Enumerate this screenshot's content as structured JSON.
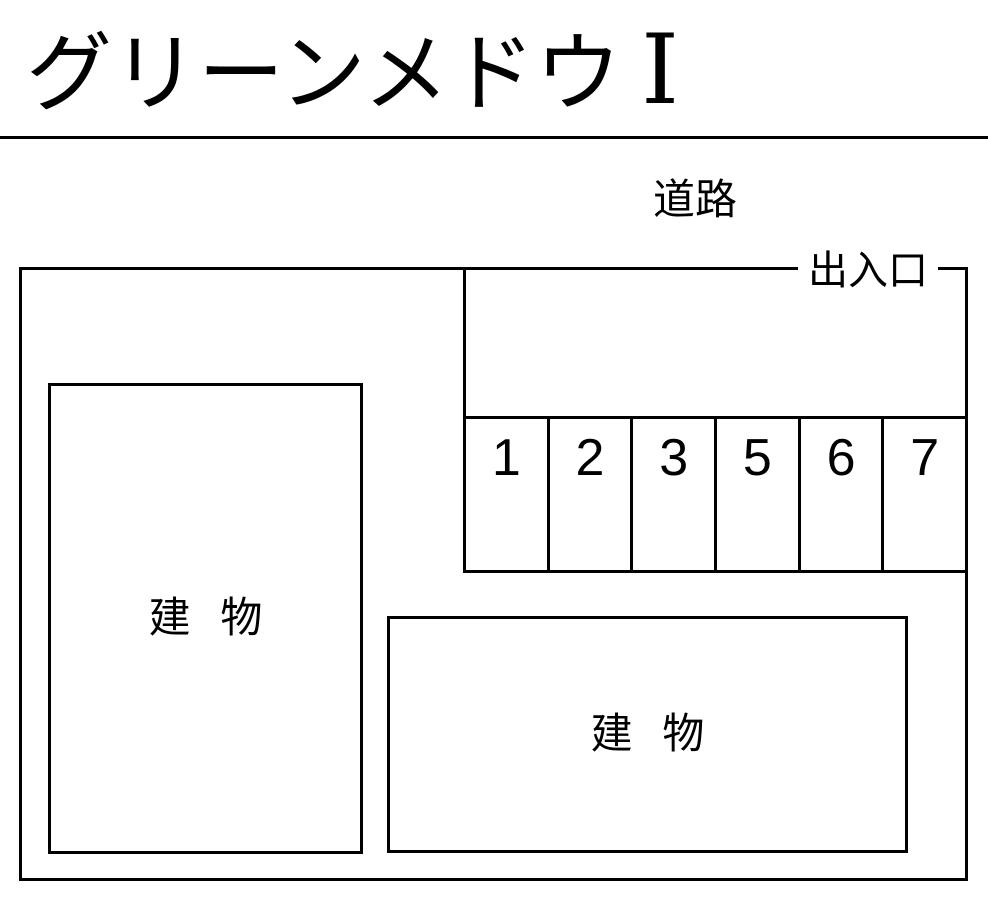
{
  "colors": {
    "background": "#ffffff",
    "line": "#000000",
    "text": "#000000"
  },
  "title": {
    "text": "グリーンメドウ",
    "numeral": "Ⅰ"
  },
  "labels": {
    "road": "道路",
    "entrance": "出入口"
  },
  "parking": {
    "spaces": [
      "1",
      "2",
      "3",
      "5",
      "6",
      "7"
    ]
  },
  "buildings": [
    {
      "label": "建 物"
    },
    {
      "label": "建 物"
    }
  ]
}
